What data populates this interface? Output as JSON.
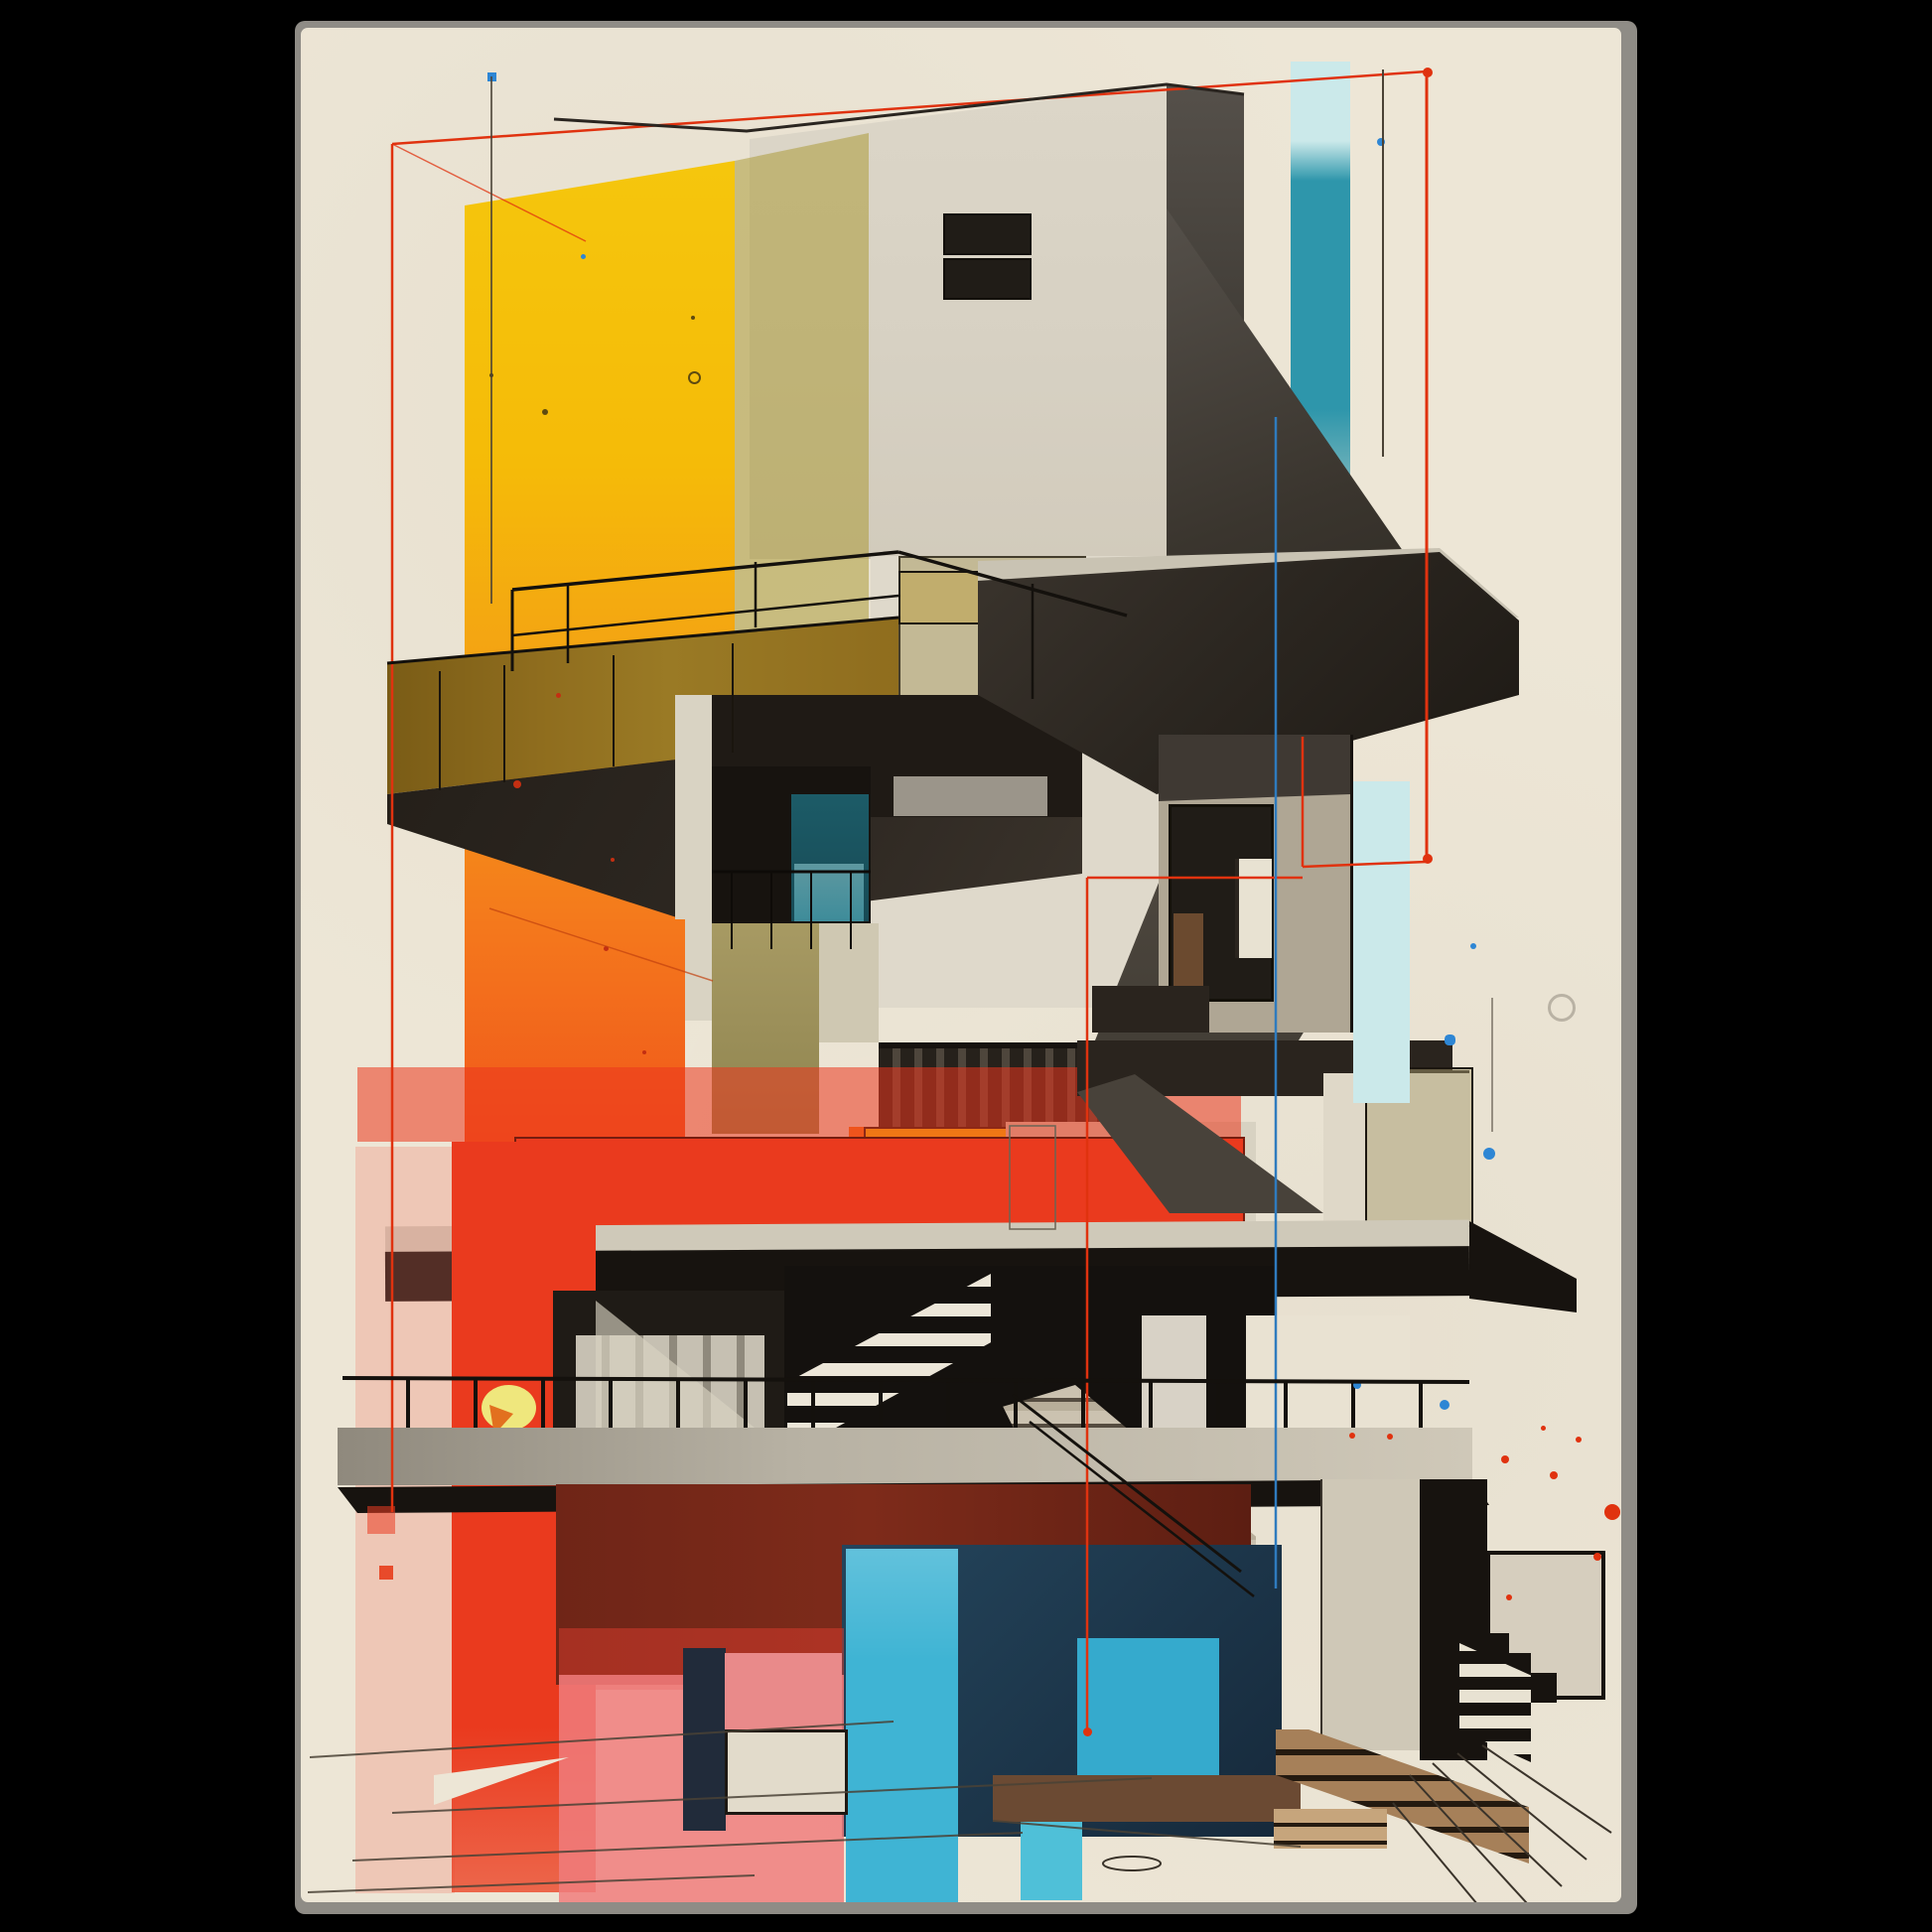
{
  "scene": {
    "type": "framed art poster mockup of an abstract architectural illustration",
    "canvas_bg": "#000000",
    "poster_bg": "#EDE6D6",
    "poster_edge": "#8F8C86"
  },
  "palette": {
    "cream": "#EDE6D6",
    "cream_bright": "#E9E2D2",
    "concrete_light": "#DCD6C8",
    "concrete_warm": "#CFC8B7",
    "concrete_gray": "#AFA694",
    "plaster_gray": "#9B958A",
    "charcoal": "#14110E",
    "dark": "#17130F",
    "dark_warm": "#2A241E",
    "dark_soft": "#453F37",
    "yellow": "#F5C60D",
    "yellow_olive": "rgba(168,150,44,0.5)",
    "orange": "#F4791C",
    "orange_red": "#EF4A1A",
    "red": "#EA3A1E",
    "red_line": "#E0320F",
    "maroon": "#6F2517",
    "pink": "#EF8C86",
    "pale_pink": "rgba(242,120,100,0.28)",
    "teal": "#2E96AB",
    "teal_pale": "#CBE9EA",
    "cyan": "#3FB4D4",
    "cyan_deep": "#35AACD",
    "cyan_light": "#4FC0D8",
    "navy": "#1B3A50",
    "blue_line": "#2F7BBE",
    "blue_dot": "#2E86D4",
    "bronze": "#8F6D1E",
    "olive_wall": "#A79A63",
    "curtain_teal": "#1D5B67",
    "curtain_light": "#C6C0B2",
    "step_tan": "#A68059",
    "brown": "#6B4A33",
    "sketch_gray": "#4A4236",
    "window_dark": "#201C17"
  },
  "artwork_elements": [
    {
      "name": "yellow-gradient-column",
      "color": "#F5C60D"
    },
    {
      "name": "orange-wash-column",
      "color": "#F4791C"
    },
    {
      "name": "concrete-cube-tower",
      "color": "#DCD6C8"
    },
    {
      "name": "teal-vertical-strip",
      "color": "#2E96AB"
    },
    {
      "name": "bronze-balcony-parapet",
      "color": "#8F6D1E"
    },
    {
      "name": "teal-curtain-window",
      "color": "#1D5B67"
    },
    {
      "name": "cantilever-roof-slab",
      "color": "#2B2620"
    },
    {
      "name": "red-overlay-band",
      "color": "#EA3A1E"
    },
    {
      "name": "yellow-accent-block",
      "color": "#F6C50B"
    },
    {
      "name": "long-floor-slab",
      "color": "#17130F"
    },
    {
      "name": "zebra-staircase",
      "color": "#ECE6D8"
    },
    {
      "name": "diagonal-stair-flight",
      "color": "#CBC2B0"
    },
    {
      "name": "maroon-texture-block",
      "color": "#6F2517"
    },
    {
      "name": "navy-block",
      "color": "#1B3A50"
    },
    {
      "name": "cyan-patch-blocks",
      "color": "#3FB4D4"
    },
    {
      "name": "pink-translucent-rect",
      "color": "#EF8C86"
    },
    {
      "name": "concrete-pillar-with-steps",
      "color": "#CFC8B7"
    },
    {
      "name": "tan-step-flight",
      "color": "#A68059"
    },
    {
      "name": "red-sketch-frame-lines",
      "color": "#E0320F"
    },
    {
      "name": "blue-sketch-line",
      "color": "#2F7BBE"
    },
    {
      "name": "paint-splatter-dots",
      "color": "#2E86D4"
    }
  ]
}
